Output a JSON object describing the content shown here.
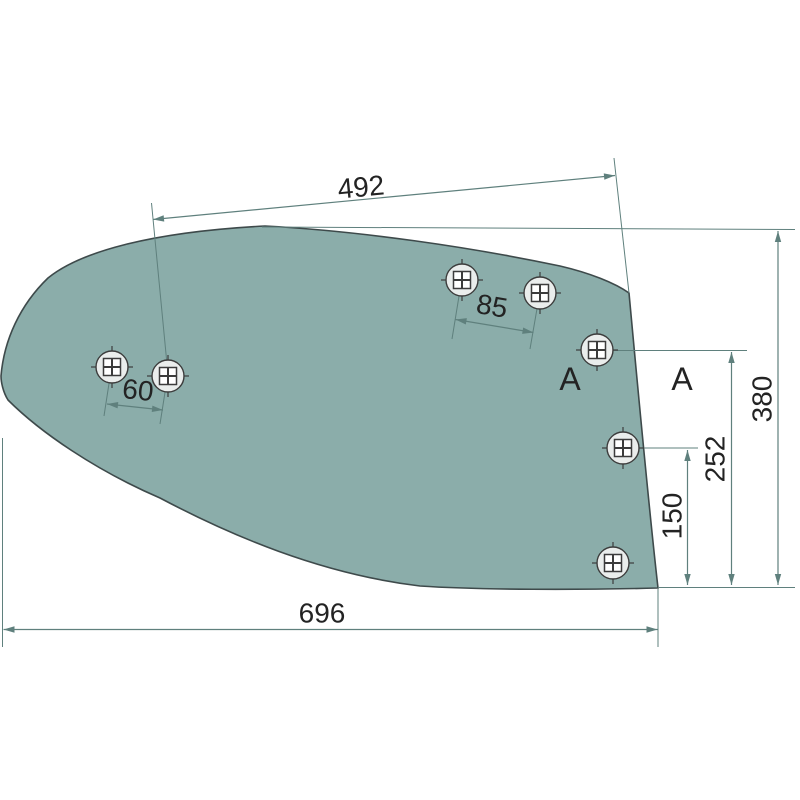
{
  "diagram": {
    "dimensions": {
      "top_width": "492",
      "top_hole_spacing": "85",
      "left_hole_spacing": "60",
      "total_height": "380",
      "upper_hole_height": "252",
      "mid_hole_height": "150",
      "bottom_width": "696"
    },
    "section_labels": {
      "left": "A",
      "right": "A"
    },
    "colors": {
      "background": "#ffffff",
      "part_fill": "#8badaa",
      "part_outline": "#3e4a4b",
      "dimension_line": "#5f807d",
      "text_color": "#232323",
      "hole_fill": "#eaedec",
      "hole_outline": "#3c3c3c"
    }
  }
}
